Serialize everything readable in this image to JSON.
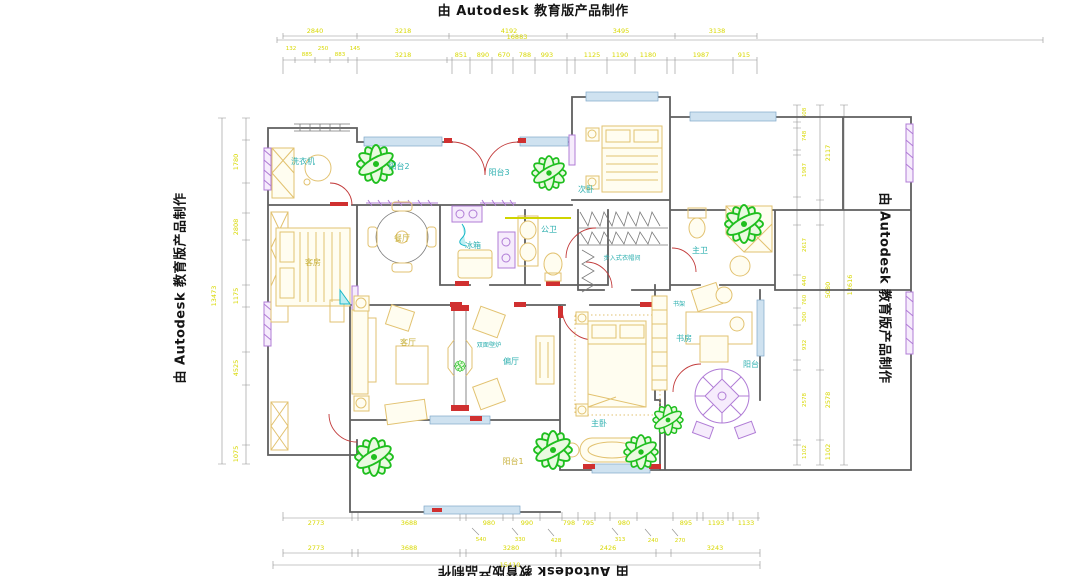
{
  "watermark": {
    "text": "由 Autodesk 教育版产品制作"
  },
  "rooms": {
    "laundry": "洗衣机",
    "guest_room": "客房",
    "balcony1": "阳台1",
    "balcony2": "阳台2",
    "balcony3": "阳台3",
    "balcony4": "阳台",
    "secondary_bedroom": "次卧",
    "dining": "餐厅",
    "fridge": "冰箱",
    "public_bath": "公卫",
    "walk_in_closet": "步入式衣帽间",
    "master_bath": "主卫",
    "bookshelf": "书架",
    "study": "书房",
    "living": "客厅",
    "fireplace": "双面壁炉",
    "lounge": "偏厅",
    "master_bedroom": "主卧"
  },
  "dims": {
    "top": {
      "total": "16883",
      "tier1": [
        "2840",
        "3218",
        "4192",
        "3495",
        "3138"
      ],
      "sub": [
        "132",
        "885",
        "250",
        "883",
        "145"
      ],
      "tier2": [
        "3218",
        "851",
        "890",
        "670",
        "788",
        "993",
        "1125",
        "1190",
        "1180",
        "1987",
        "915"
      ]
    },
    "bottom": {
      "total": "15410",
      "tierA": [
        "2773",
        "3688",
        "980",
        "990",
        "798",
        "795",
        "980",
        "895",
        "1193",
        "1133"
      ],
      "small": [
        "540",
        "330",
        "428",
        "313",
        "240",
        "270"
      ],
      "tierB": [
        "2773",
        "3688",
        "3280",
        "2426",
        "3243"
      ]
    },
    "left": {
      "total": "13473",
      "segs": [
        "1780",
        "2808",
        "1175",
        "4525",
        "1075"
      ]
    },
    "right": {
      "total": "12616",
      "inner": [
        "608",
        "748",
        "1987",
        "2617",
        "440",
        "760",
        "300",
        "932",
        "2578",
        "1102"
      ],
      "outer": [
        "2117",
        "5080",
        "2578",
        "1102"
      ]
    }
  },
  "colors": {
    "dimension_text": "#d8d800",
    "room_label_teal": "#2fb0b0",
    "room_label_yellow": "#c8b23e",
    "wall_gray": "#5f5f5f",
    "door_red": "#c23b3b",
    "window_blue": "#a9c9e4",
    "fixture_purple": "#b07cd6",
    "plant_green": "#1fbf1f",
    "furniture_yellow": "#e2c270"
  }
}
